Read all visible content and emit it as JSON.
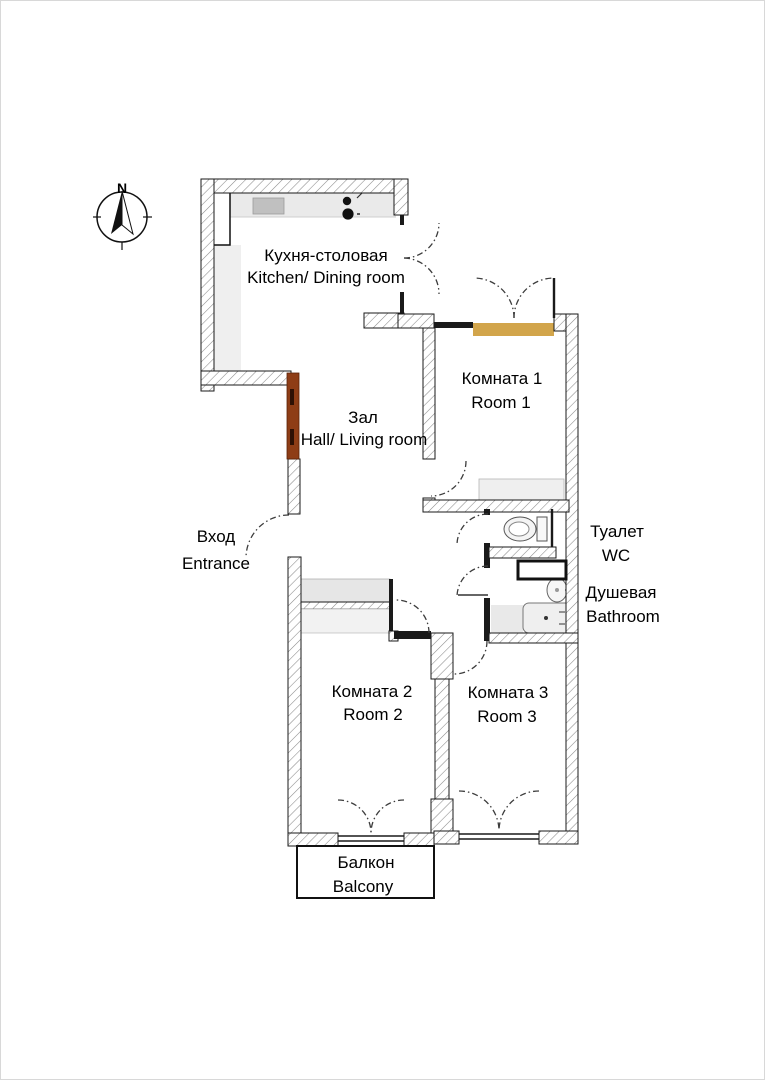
{
  "compass": {
    "north_label": "N"
  },
  "labels": {
    "kitchen": {
      "ru": "Кухня-столовая",
      "en": "Kitchen/ Dining room"
    },
    "hall": {
      "ru": "Зал",
      "en": "Hall/ Living room"
    },
    "entrance": {
      "ru": "Вход",
      "en": "Entrance"
    },
    "room1": {
      "ru": "Комната 1",
      "en": "Room 1"
    },
    "wc": {
      "ru": "Туалет",
      "en": "WC"
    },
    "bathroom": {
      "ru": "Душевая",
      "en": "Bathroom"
    },
    "room2": {
      "ru": "Комната 2",
      "en": "Room 2"
    },
    "room3": {
      "ru": "Комната 3",
      "en": "Room 3"
    },
    "balcony": {
      "ru": "Балкон",
      "en": "Balcony"
    }
  },
  "colors": {
    "wall_outline": "#1a1a1a",
    "hatch_line": "#8a8a8a",
    "door_threshold_tan": "#D2A54B",
    "entrance_door_brown": "#8E3D16",
    "counter_grey": "#EAEAEA",
    "sink_grey": "#C0C0C0",
    "closet_grey": "#E6E6E6",
    "closet_grey_light": "#F2F2F2",
    "fixture_grey": "#EFEFEF",
    "bath_floor_grey": "#E9E9E9"
  }
}
